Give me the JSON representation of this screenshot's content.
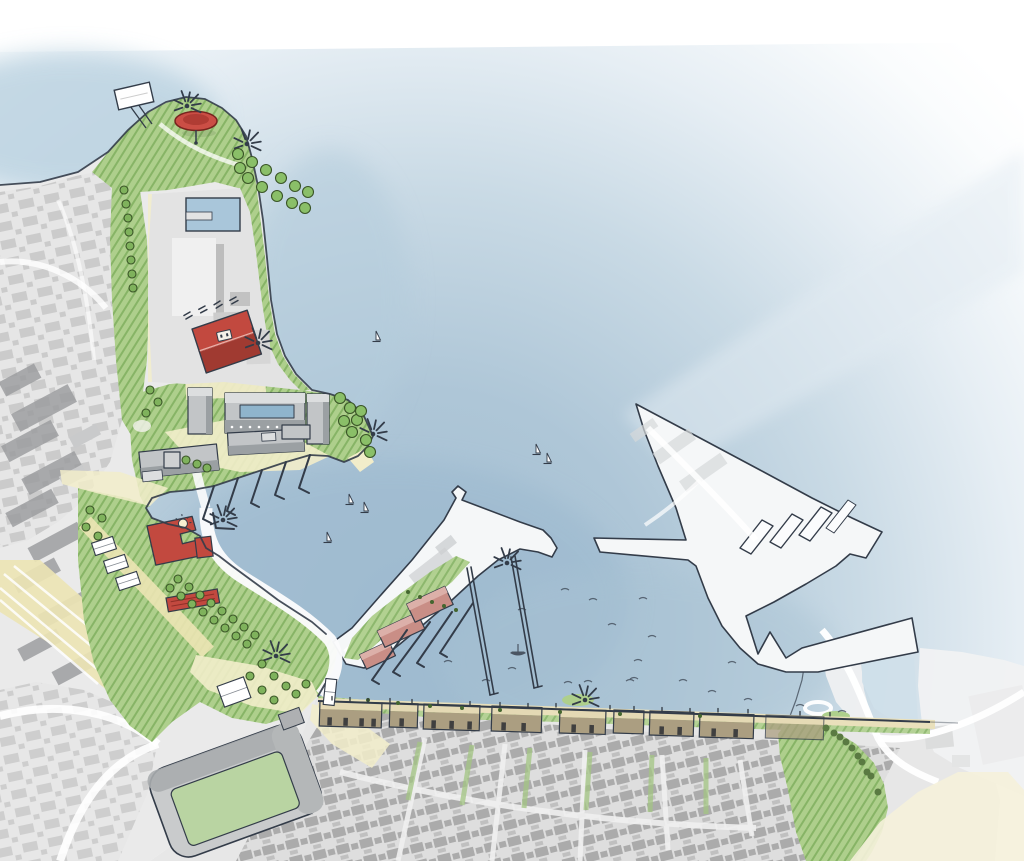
{
  "scene": {
    "width": 1024,
    "height": 861
  },
  "palette": {
    "outline": "#333c49",
    "water-deep": "#9db9cf",
    "water-mid": "#bed3e1",
    "water-pale": "#e7eff5",
    "land": "#eaeaea",
    "city-base": "#e6e6e6",
    "city-block": "#c9c9c9",
    "city-base-dense": "#dedede",
    "city-block-dense": "#ababab",
    "slab": "#9c9ea0",
    "green": "#aecf8c",
    "green-hatch": "#679e47",
    "green-dark": "#3a5527",
    "tree": "#7fb25c",
    "shrub": "#8abf68",
    "green-light": "#cfe3ae",
    "cream": "#f2edca",
    "cream2": "#ece4b4",
    "red": "#c2493f",
    "red-dark": "#a03a31",
    "red-ridge": "#e8b0a8",
    "pink": "#c98e86",
    "pink-light": "#dcb0a9",
    "tan-roof": "#e4d9b4",
    "tan-front": "#ab9e81",
    "quay-strip": "#e9e0bb",
    "door": "#3f3f3f",
    "bldg": "#c2c5c7",
    "bldg-top": "#dcdedf",
    "bldg-side": "#9ba0a3",
    "glass": "#8fb4cc",
    "pier-white": "#f5f7f8",
    "pitch": "#b9d4a2",
    "stand": "#c9cbcc",
    "stand-dark": "#a9acae",
    "white": "#ffffff"
  },
  "decorations": {
    "starbursts": [
      [
        187,
        106
      ],
      [
        247,
        144
      ],
      [
        258,
        343
      ],
      [
        373,
        434
      ],
      [
        223,
        520
      ],
      [
        276,
        656
      ],
      [
        507,
        563
      ],
      [
        585,
        700
      ]
    ],
    "sailboats": [
      [
        376,
        340
      ],
      [
        349,
        503
      ],
      [
        364,
        511
      ],
      [
        327,
        541
      ],
      [
        536,
        453
      ],
      [
        547,
        462
      ]
    ],
    "rowboat": [
      518,
      653
    ],
    "water_marks": [
      [
        448,
        662
      ],
      [
        512,
        669
      ],
      [
        568,
        683
      ],
      [
        634,
        679
      ],
      [
        486,
        681
      ],
      [
        593,
        600
      ],
      [
        612,
        625
      ],
      [
        638,
        661
      ],
      [
        652,
        637
      ],
      [
        732,
        663
      ],
      [
        588,
        682
      ],
      [
        630,
        681
      ],
      [
        683,
        681
      ],
      [
        712,
        692
      ],
      [
        748,
        700
      ],
      [
        800,
        706
      ],
      [
        842,
        712
      ],
      [
        643,
        599
      ],
      [
        522,
        610
      ],
      [
        565,
        590
      ]
    ],
    "tree_groups": [
      {
        "name": "street-tree",
        "r": 4,
        "fill": "#7fb25c",
        "stroke": "#3a5527",
        "points": [
          [
            124,
            190
          ],
          [
            126,
            204
          ],
          [
            128,
            218
          ],
          [
            129,
            232
          ],
          [
            130,
            246
          ],
          [
            131,
            260
          ],
          [
            132,
            274
          ],
          [
            133,
            288
          ],
          [
            170,
            588
          ],
          [
            181,
            596
          ],
          [
            192,
            604
          ],
          [
            203,
            612
          ],
          [
            214,
            620
          ],
          [
            225,
            628
          ],
          [
            236,
            636
          ],
          [
            247,
            644
          ],
          [
            178,
            579
          ],
          [
            189,
            587
          ],
          [
            200,
            595
          ],
          [
            211,
            603
          ],
          [
            222,
            611
          ],
          [
            233,
            619
          ],
          [
            244,
            627
          ],
          [
            255,
            635
          ],
          [
            262,
            664
          ],
          [
            274,
            676
          ],
          [
            286,
            686
          ],
          [
            250,
            676
          ],
          [
            262,
            690
          ],
          [
            238,
            692
          ],
          [
            274,
            700
          ],
          [
            296,
            694
          ],
          [
            306,
            684
          ],
          [
            90,
            510
          ],
          [
            102,
            518
          ],
          [
            86,
            527
          ],
          [
            98,
            536
          ],
          [
            110,
            545
          ],
          [
            150,
            390
          ],
          [
            158,
            402
          ],
          [
            146,
            413
          ],
          [
            186,
            460
          ],
          [
            197,
            464
          ],
          [
            207,
            468
          ]
        ]
      },
      {
        "name": "shrub",
        "r": 5.5,
        "fill": "#8abf68",
        "stroke": "#3a5527",
        "points": [
          [
            238,
            154
          ],
          [
            252,
            162
          ],
          [
            266,
            170
          ],
          [
            281,
            178
          ],
          [
            295,
            186
          ],
          [
            308,
            192
          ],
          [
            248,
            178
          ],
          [
            262,
            187
          ],
          [
            277,
            196
          ],
          [
            292,
            203
          ],
          [
            305,
            208
          ],
          [
            240,
            168
          ],
          [
            340,
            398
          ],
          [
            350,
            408
          ],
          [
            357,
            420
          ],
          [
            344,
            421
          ],
          [
            352,
            432
          ],
          [
            361,
            411
          ],
          [
            366,
            440
          ],
          [
            370,
            452
          ]
        ]
      },
      {
        "name": "quay-dot-tree",
        "r": 2,
        "fill": "#44662f",
        "stroke": "none",
        "points": [
          [
            368,
            700
          ],
          [
            398,
            703
          ],
          [
            430,
            706
          ],
          [
            462,
            708
          ],
          [
            500,
            710
          ],
          [
            560,
            712
          ],
          [
            620,
            714
          ],
          [
            700,
            716
          ],
          [
            408,
            592
          ],
          [
            420,
            597
          ],
          [
            432,
            602
          ],
          [
            444,
            606
          ],
          [
            456,
            610
          ]
        ]
      },
      {
        "name": "hill-tree",
        "r": 3.5,
        "fill": "#5a7a42",
        "stroke": "none",
        "points": [
          [
            826,
            728
          ],
          [
            840,
            737
          ],
          [
            852,
            748
          ],
          [
            862,
            762
          ],
          [
            871,
            776
          ],
          [
            878,
            792
          ],
          [
            846,
            742
          ],
          [
            858,
            756
          ],
          [
            867,
            772
          ],
          [
            834,
            733
          ]
        ]
      }
    ],
    "tents": [
      {
        "x": 104,
        "y": 546,
        "w": 22,
        "h": 13,
        "r": -18
      },
      {
        "x": 116,
        "y": 564,
        "w": 22,
        "h": 13,
        "r": -18
      },
      {
        "x": 128,
        "y": 581,
        "w": 22,
        "h": 13,
        "r": -18
      },
      {
        "x": 234,
        "y": 692,
        "w": 28,
        "h": 22,
        "r": -20
      },
      {
        "x": 330,
        "y": 692,
        "w": 11,
        "h": 26,
        "r": 6
      }
    ],
    "tick_marks": [
      {
        "x": 190,
        "y": 312,
        "r": 60
      },
      {
        "x": 205,
        "y": 306,
        "r": 62
      },
      {
        "x": 220,
        "y": 301,
        "r": 58
      },
      {
        "x": 236,
        "y": 297,
        "r": 61
      }
    ],
    "quay_people": [
      [
        332,
        700
      ],
      [
        350,
        701
      ],
      [
        368,
        702
      ],
      [
        390,
        702
      ],
      [
        412,
        703
      ],
      [
        438,
        704
      ],
      [
        470,
        705
      ],
      [
        500,
        706
      ],
      [
        528,
        707
      ],
      [
        556,
        707
      ],
      [
        610,
        709
      ],
      [
        634,
        710
      ],
      [
        662,
        711
      ],
      [
        690,
        712
      ],
      [
        718,
        712
      ],
      [
        748,
        713
      ],
      [
        800,
        715
      ],
      [
        830,
        716
      ]
    ]
  }
}
